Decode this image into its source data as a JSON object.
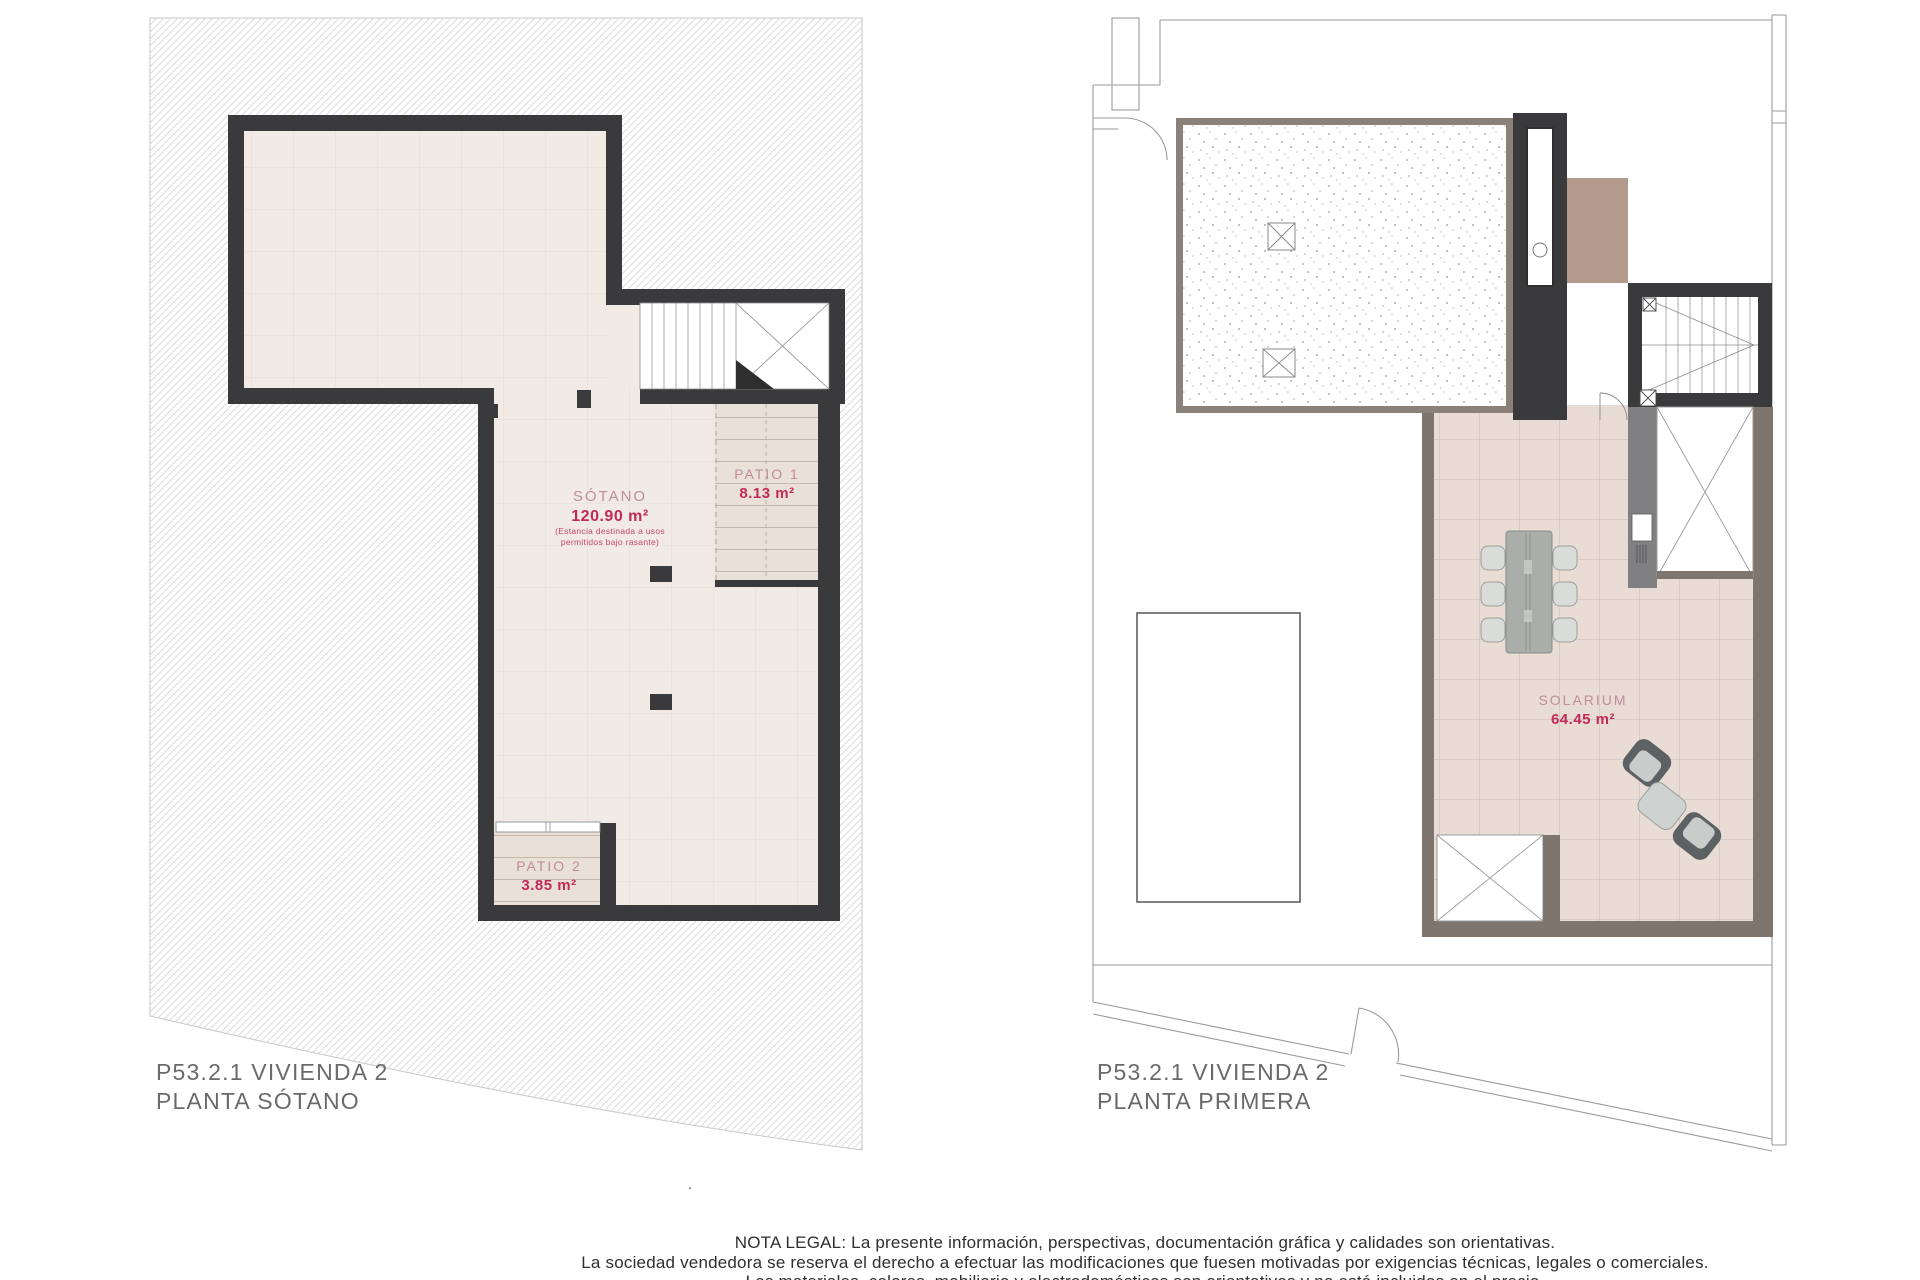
{
  "left_plan": {
    "caption": {
      "line1": "P53.2.1 VIVIENDA 2",
      "line2": "PLANTA SÓTANO"
    },
    "rooms": {
      "sotano": {
        "name": "SÓTANO",
        "area": "120.90 m²",
        "note1": "(Estancia destinada a usos",
        "note2": "permitidos bajo rasante)"
      },
      "patio1": {
        "name": "PATIO 1",
        "area": "8.13 m²"
      },
      "patio2": {
        "name": "PATIO 2",
        "area": "3.85 m²"
      }
    }
  },
  "right_plan": {
    "caption": {
      "line1": "P53.2.1 VIVIENDA 2",
      "line2": "PLANTA PRIMERA"
    },
    "rooms": {
      "solarium": {
        "name": "SOLARIUM",
        "area": "64.45 m²"
      }
    }
  },
  "legal_note": {
    "line1": "NOTA LEGAL: La presente información, perspectivas, documentación gráfica y calidades son orientativas.",
    "line2": "La sociedad vendedora se reserva el derecho a efectuar las modificaciones que fuesen motivadas por exigencias técnicas, legales o comerciales.",
    "line3": "Los materiales, colores, mobiliario y electrodomésticos son orientativos y no está incluidos en el precio.",
    "separator_dot": "."
  },
  "colors": {
    "wall_dark": "#3a3a3c",
    "wall_taupe": "#7e756e",
    "floor_basement": "#f1eae5",
    "floor_patio": "#e9e0d8",
    "floor_tile": "#e8dcd5",
    "room_label": "#c08d9b",
    "area_value": "#c22a5a",
    "caption_text": "#6a6a6a",
    "accent_brown": "#b49a8c"
  }
}
